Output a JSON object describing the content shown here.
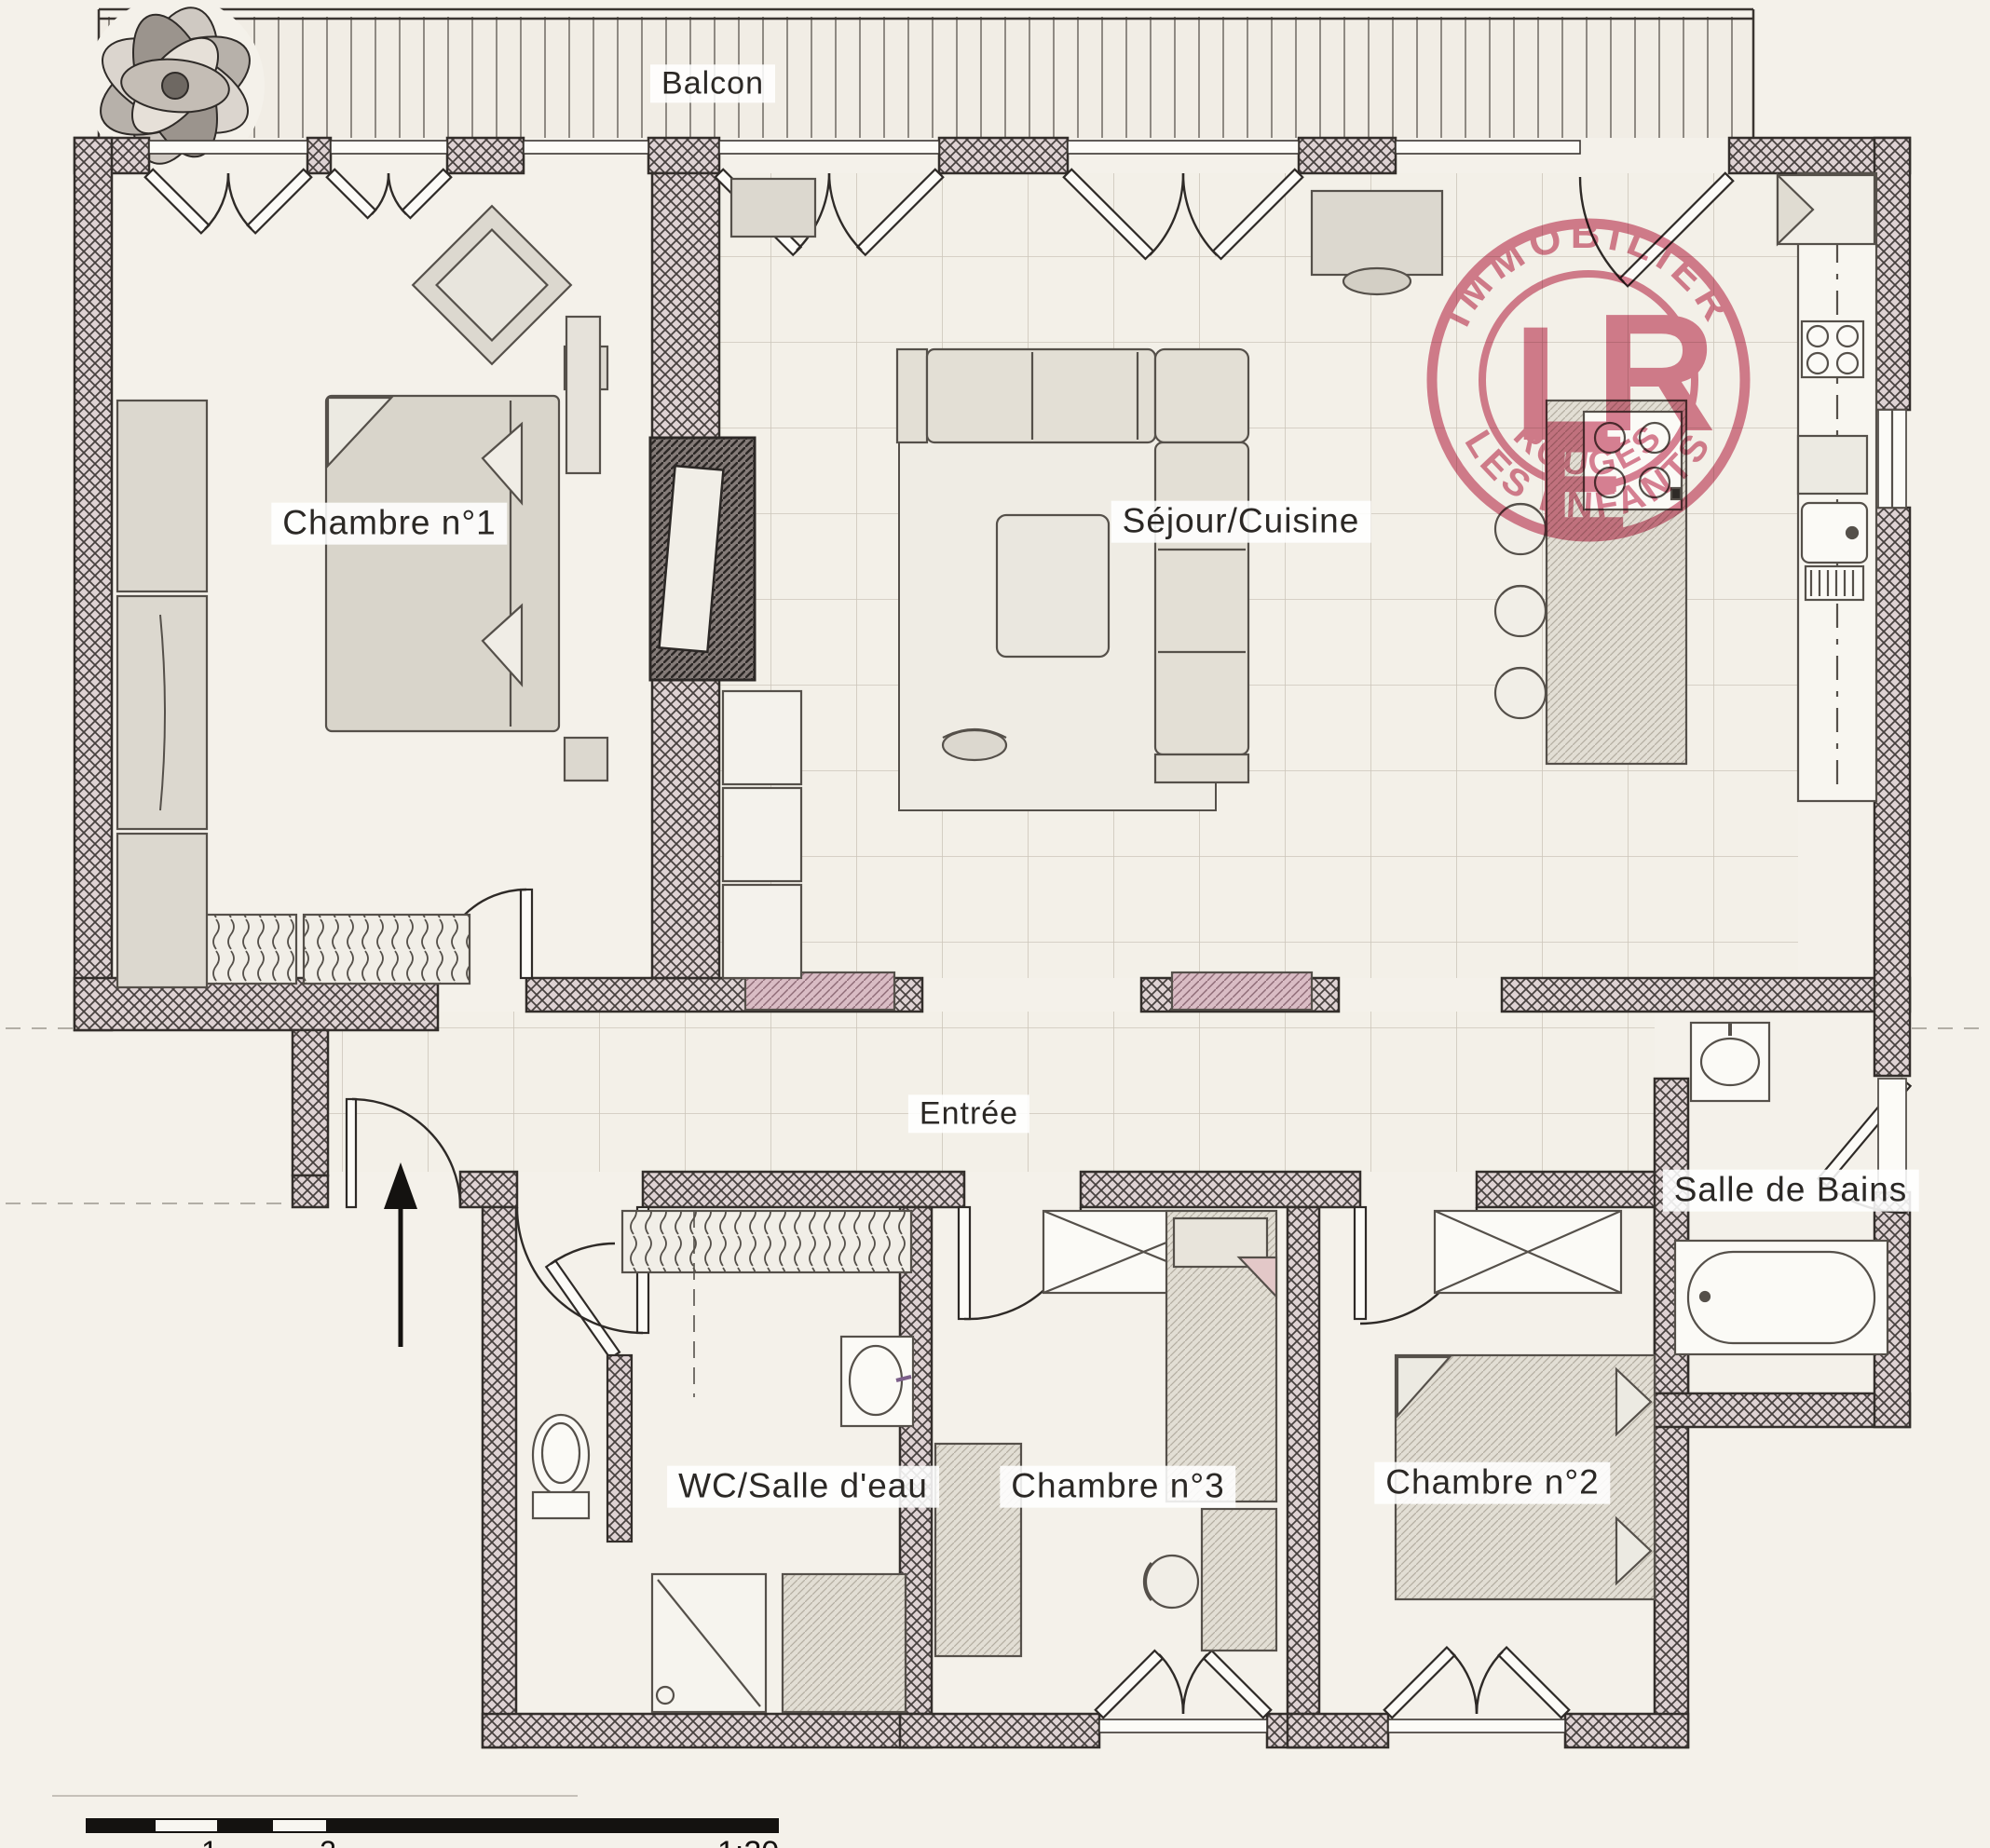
{
  "rooms": {
    "balcony": {
      "label": "Balcon"
    },
    "bedroom1": {
      "label": "Chambre n°1"
    },
    "living_kitchen": {
      "label": "Séjour/Cuisine"
    },
    "entrance": {
      "label": "Entrée"
    },
    "bathroom": {
      "label": "Salle de Bains"
    },
    "wc_shower": {
      "label": "WC/Salle d'eau"
    },
    "bedroom3": {
      "label": "Chambre n°3"
    },
    "bedroom2": {
      "label": "Chambre n°2"
    }
  },
  "stamp": {
    "top_text": "IMMOBILIER",
    "bottom_text_outer": "LES ENFANTS",
    "bottom_text_inner": "ROUGES",
    "monogram_l": "L",
    "monogram_e": "E",
    "monogram_r": "R",
    "color": "#cf5f78"
  },
  "scale_bar": {
    "tick_1": "1",
    "tick_2": "2",
    "ratio": "1:20"
  }
}
